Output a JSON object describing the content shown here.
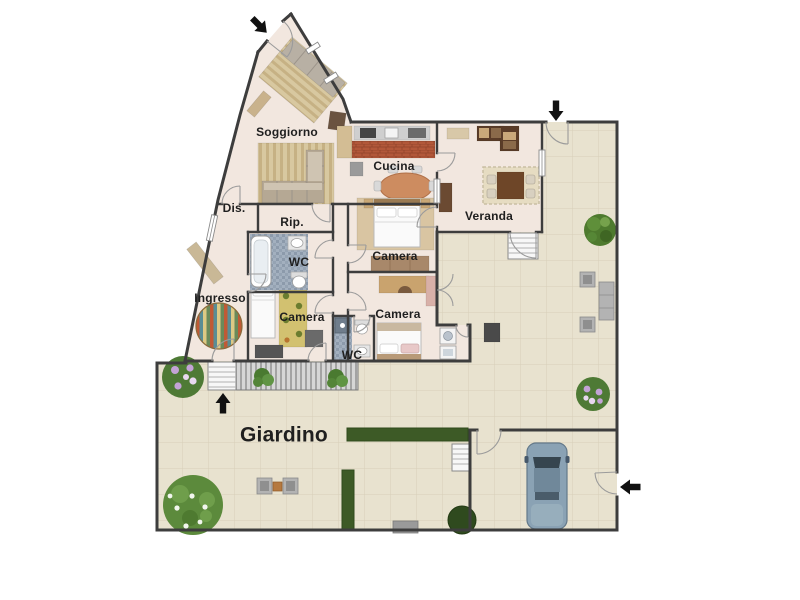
{
  "floorplan": {
    "labels": [
      {
        "id": "soggiorno",
        "text": "Soggiorno",
        "x": 287,
        "y": 132,
        "size": 12
      },
      {
        "id": "cucina",
        "text": "Cucina",
        "x": 394,
        "y": 166,
        "size": 12
      },
      {
        "id": "veranda",
        "text": "Veranda",
        "x": 489,
        "y": 216,
        "size": 12
      },
      {
        "id": "dis",
        "text": "Dis.",
        "x": 234,
        "y": 208,
        "size": 12
      },
      {
        "id": "rip",
        "text": "Rip.",
        "x": 292,
        "y": 222,
        "size": 12
      },
      {
        "id": "wc-1",
        "text": "WC",
        "x": 299,
        "y": 262,
        "size": 12
      },
      {
        "id": "ingresso",
        "text": "Ingresso",
        "x": 220,
        "y": 298,
        "size": 12
      },
      {
        "id": "camera-1",
        "text": "Camera",
        "x": 395,
        "y": 256,
        "size": 12
      },
      {
        "id": "camera-2",
        "text": "Camera",
        "x": 302,
        "y": 317,
        "size": 12
      },
      {
        "id": "camera-3",
        "text": "Camera",
        "x": 398,
        "y": 314,
        "size": 12
      },
      {
        "id": "wc-2",
        "text": "WC",
        "x": 352,
        "y": 355,
        "size": 12
      },
      {
        "id": "giardino",
        "text": "Giardino",
        "x": 284,
        "y": 434,
        "size": 21
      }
    ],
    "entrance_arrows": [
      {
        "name": "main-entrance-arrow",
        "x": 259,
        "y": 25,
        "rotation": 135
      },
      {
        "name": "terrace-gate-arrow",
        "x": 556,
        "y": 110,
        "rotation": 180
      },
      {
        "name": "driveway-gate-arrow",
        "x": 631,
        "y": 487,
        "rotation": 270
      },
      {
        "name": "garden-stairs-arrow",
        "x": 223,
        "y": 404,
        "rotation": 0
      }
    ],
    "colors": {
      "wall": "#3d3d3d",
      "indoor_floor": "#f2e7df",
      "outdoor_floor": "#e8e2cf",
      "outdoor_grid": "#d7cfb8",
      "deck": "#d6d6d6",
      "hedge": "#3d5a26",
      "car_body": "#8aa2b4",
      "kitchen_tiles": "#b2583a",
      "mosaic_tiles": "#a3b0bf",
      "label_text": "#1f1f1f",
      "arrow": "#111111"
    }
  }
}
